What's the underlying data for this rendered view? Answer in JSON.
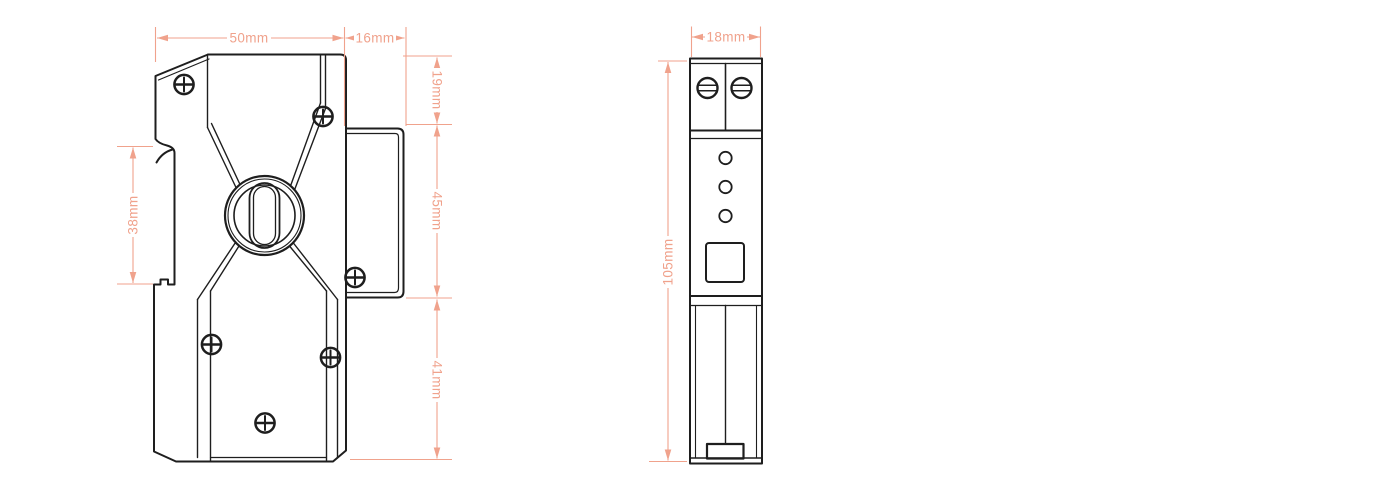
{
  "drawing": {
    "type": "technical-dimension-drawing",
    "subject": "din-rail-surge-protector",
    "front_view": {
      "dimensions": {
        "width_main": "50mm",
        "width_block": "16mm",
        "height_top": "19mm",
        "height_block": "45mm",
        "height_bottom": "41mm",
        "rail_clip_height": "38mm"
      },
      "screw_count": 6
    },
    "side_view": {
      "dimensions": {
        "width": "18mm",
        "height": "105mm"
      },
      "terminal_screw_count": 2,
      "led_count": 3
    },
    "colors": {
      "outline": "#1e1e1e",
      "dimension": "#f0a28c",
      "background": "#ffffff"
    }
  }
}
